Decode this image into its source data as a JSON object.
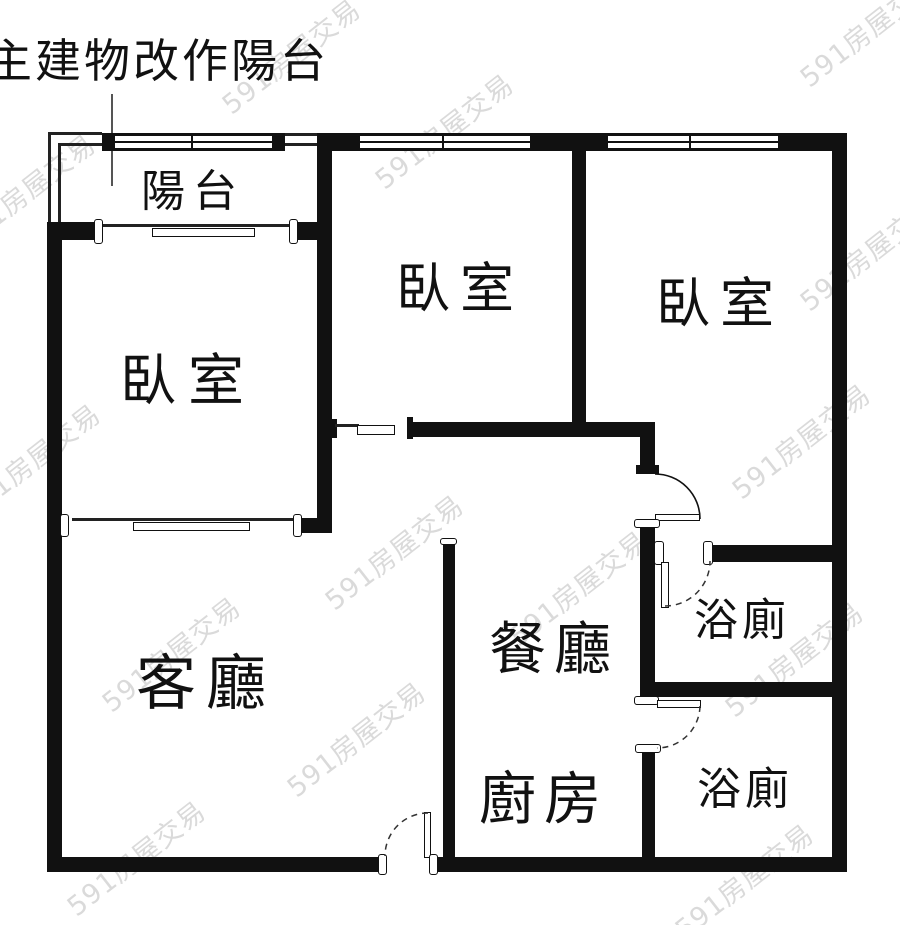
{
  "annotation": {
    "label": "主建物改作陽台"
  },
  "watermark": {
    "text": "591房屋交易"
  },
  "rooms": {
    "balcony": {
      "label": "陽台"
    },
    "bedroom_left": {
      "label": "臥室"
    },
    "bedroom_middle": {
      "label": "臥室"
    },
    "bedroom_right": {
      "label": "臥室"
    },
    "living_room": {
      "label": "客廳"
    },
    "dining_room": {
      "label": "餐廳"
    },
    "kitchen": {
      "label": "廚房"
    },
    "bathroom_upper": {
      "label": "浴廁"
    },
    "bathroom_lower": {
      "label": "浴廁"
    }
  },
  "colors": {
    "wall": "#111111",
    "line": "#222222",
    "watermark": "#bdbdbd",
    "background": "#ffffff"
  }
}
